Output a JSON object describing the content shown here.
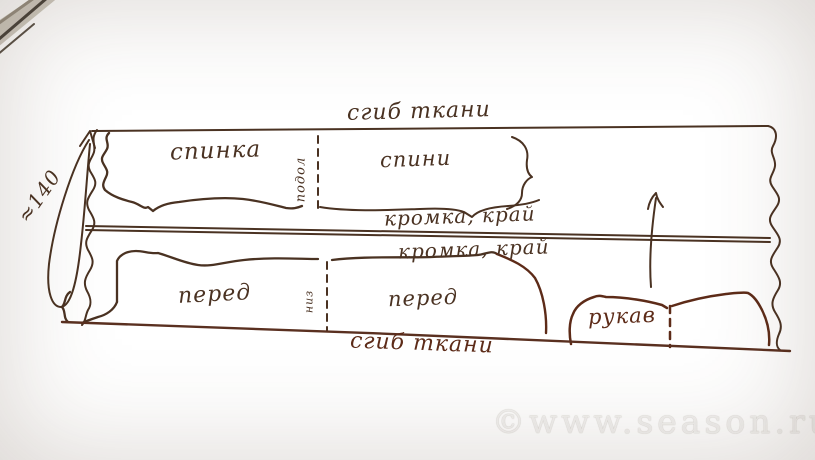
{
  "labels": {
    "fold_top": "сгиб ткани",
    "back_left": "спинка",
    "hem_vertical": "подол",
    "back_right": "спини",
    "selvage_top": "кромка, край",
    "selvage_bottom": "кромка, край",
    "front_left": "перед",
    "bottom_vertical": "низ",
    "front_right": "перед",
    "sleeve": "рукав",
    "fold_bottom": "сгиб ткани",
    "fabric_width": "≈140"
  },
  "watermark": "©www.season.ru",
  "colors": {
    "ink": "#4a3222",
    "ink_dark": "#5d2b18",
    "paper": "#d9cab7",
    "watermark_text": "#ffffff",
    "metal": "#cfcac0"
  }
}
